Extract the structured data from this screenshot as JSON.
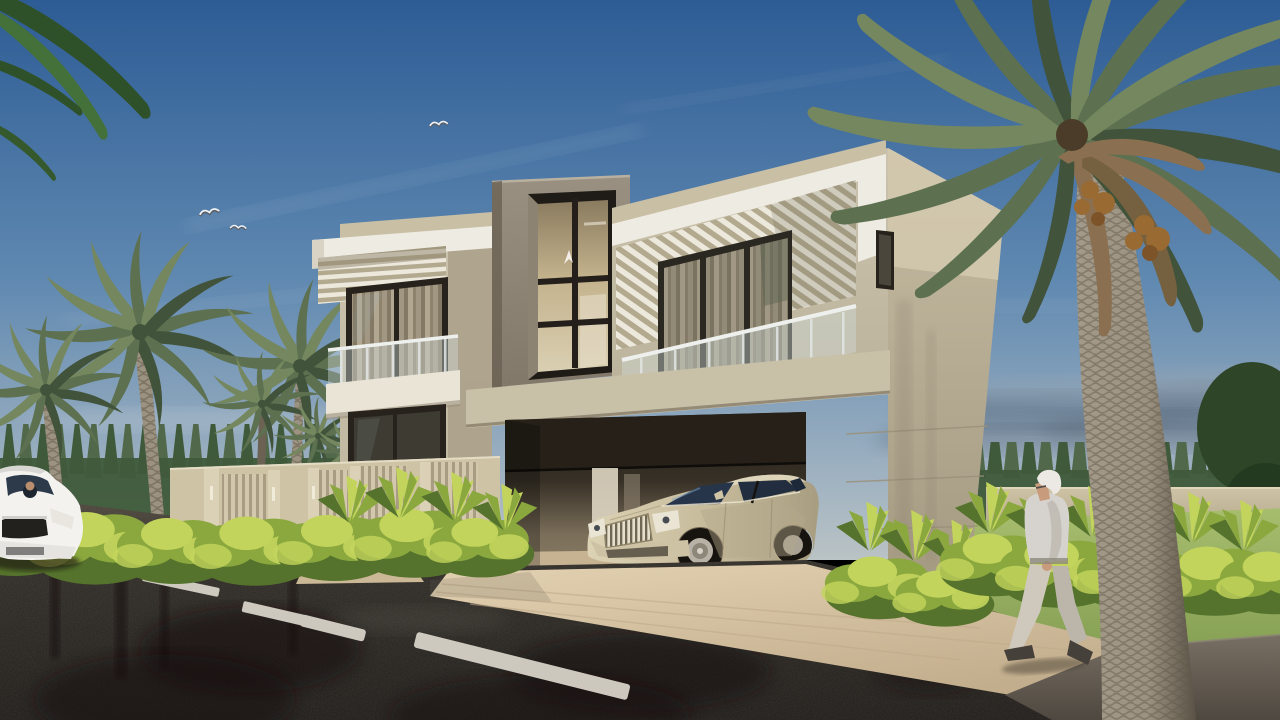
{
  "scene": {
    "label": "3D architectural rendering of a modern two-story beige villa with open carport, champagne luxury sedan, palm trees, hedges, wet asphalt road and an elderly pedestrian",
    "objects": [
      "sky",
      "cirrus-clouds",
      "gray-horizon-clouds",
      "flying-birds",
      "overhanging-leaves",
      "pine-treeline",
      "boundary-wall",
      "entry-gate",
      "slatted-fence",
      "wall-sconces",
      "left-palm-cluster",
      "right-date-palm",
      "modern-villa",
      "louvered-pergolas",
      "glass-balcony-railings",
      "tall-atrium-window",
      "bird-window-decal",
      "carport-opening",
      "sectional-garage-door",
      "luxury-sedan",
      "paved-driveway-apron",
      "walkway",
      "hedges",
      "spiky-shrubs",
      "lawn",
      "wet-asphalt-road",
      "lane-marking-dashes",
      "road-reflections",
      "white-car-with-driver",
      "sidewalk-pavement",
      "elderly-pedestrian"
    ]
  },
  "colors": {
    "sky_top": "#2d5c95",
    "sky_mid": "#6089b1",
    "sky_low": "#9fb2c1",
    "sky_horizon": "#bac3c5",
    "cloud_dark": "#5c6a7c",
    "cloud_light": "#93a2b0",
    "pine_dark": "#3f5a3a",
    "pine_light": "#51694a",
    "pine_deep": "#2e4527",
    "wall": "#cfc3a6",
    "wall_shade": "#b2a78b",
    "house_face": "#cbc3ad",
    "house_face_low": "#bdb49d",
    "house_white": "#eeebe2",
    "house_tan": "#c9bfa5",
    "house_side_shade": "#aaa089",
    "tower_hi": "#978d7e",
    "tower_lo": "#7e7466",
    "tower_dark": "#6b6254",
    "frame_dark": "#27221c",
    "glass_warm": "#c3b28c",
    "glass_warm_hi": "#dacfb2",
    "glass_dark": "#3e3b33",
    "curtain_hi": "#d8ccb2",
    "curtain_lo": "#a99c82",
    "rail_glass": "#cfdcd8",
    "rail_metal": "#eef0ee",
    "louver_white": "#ece8dc",
    "louver_gap": "#b3a98f",
    "garage_top": "#231f18",
    "garage_back": "#7b6f5a",
    "garage_floor": "#c7b392",
    "apron_hi": "#e3d2b2",
    "apron_lo": "#c2ad8c",
    "plank": "#bfa98a",
    "road_hi": "#4a443a",
    "road_mid": "#2e2a25",
    "road_lo": "#1f1c19",
    "reflect": "#13100d",
    "dash": "#dcd7cc",
    "pave_hi": "#797064",
    "pave_lo": "#4e4840",
    "grass_hi": "#a7bd6e",
    "grass_lo": "#7f9a4f",
    "bush_dark": "#55732c",
    "bush_mid": "#8aa83e",
    "bush_light": "#c3d45c",
    "trunk_hi": "#9c9281",
    "trunk_lo": "#6b6253",
    "frond_dark": "#41533a",
    "frond_mid": "#5d7050",
    "frond_light": "#75875e",
    "frond_dead": "#8a7050",
    "dates": "#9a6a33",
    "car_hi": "#dcd2b4",
    "car_lo": "#a89d80",
    "car_glass": "#27354a",
    "chrome": "#e6dfcb",
    "tire": "#17130f",
    "rim": "#b8b2a6",
    "white_car": "#f3f2ef",
    "skin": "#c79b7b",
    "hair_white": "#ece9e4",
    "shirt": "#d6d3ce",
    "pants": "#cfc9bd",
    "shoe": "#45403a"
  }
}
